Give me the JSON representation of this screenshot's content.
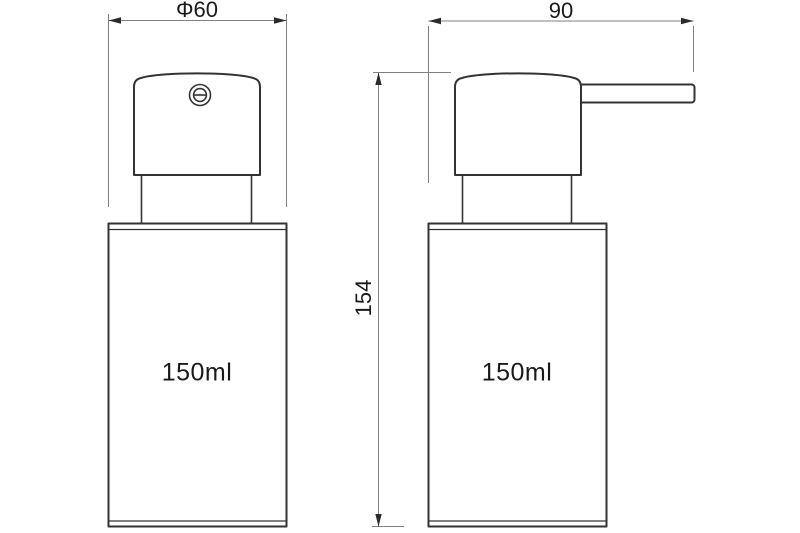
{
  "dimensions": {
    "diameter_label": "Φ60",
    "width_label": "90",
    "height_label": "154"
  },
  "front_view": {
    "volume_label": "150ml"
  },
  "side_view": {
    "volume_label": "150ml"
  },
  "icons": {
    "pump_top": "screw-slot-circle-icon"
  },
  "colors": {
    "outline": "#333333",
    "dimension_line": "#7f7f7f",
    "arrow": "#2b2b2b",
    "text": "#1a1a1a",
    "background": "#ffffff"
  }
}
